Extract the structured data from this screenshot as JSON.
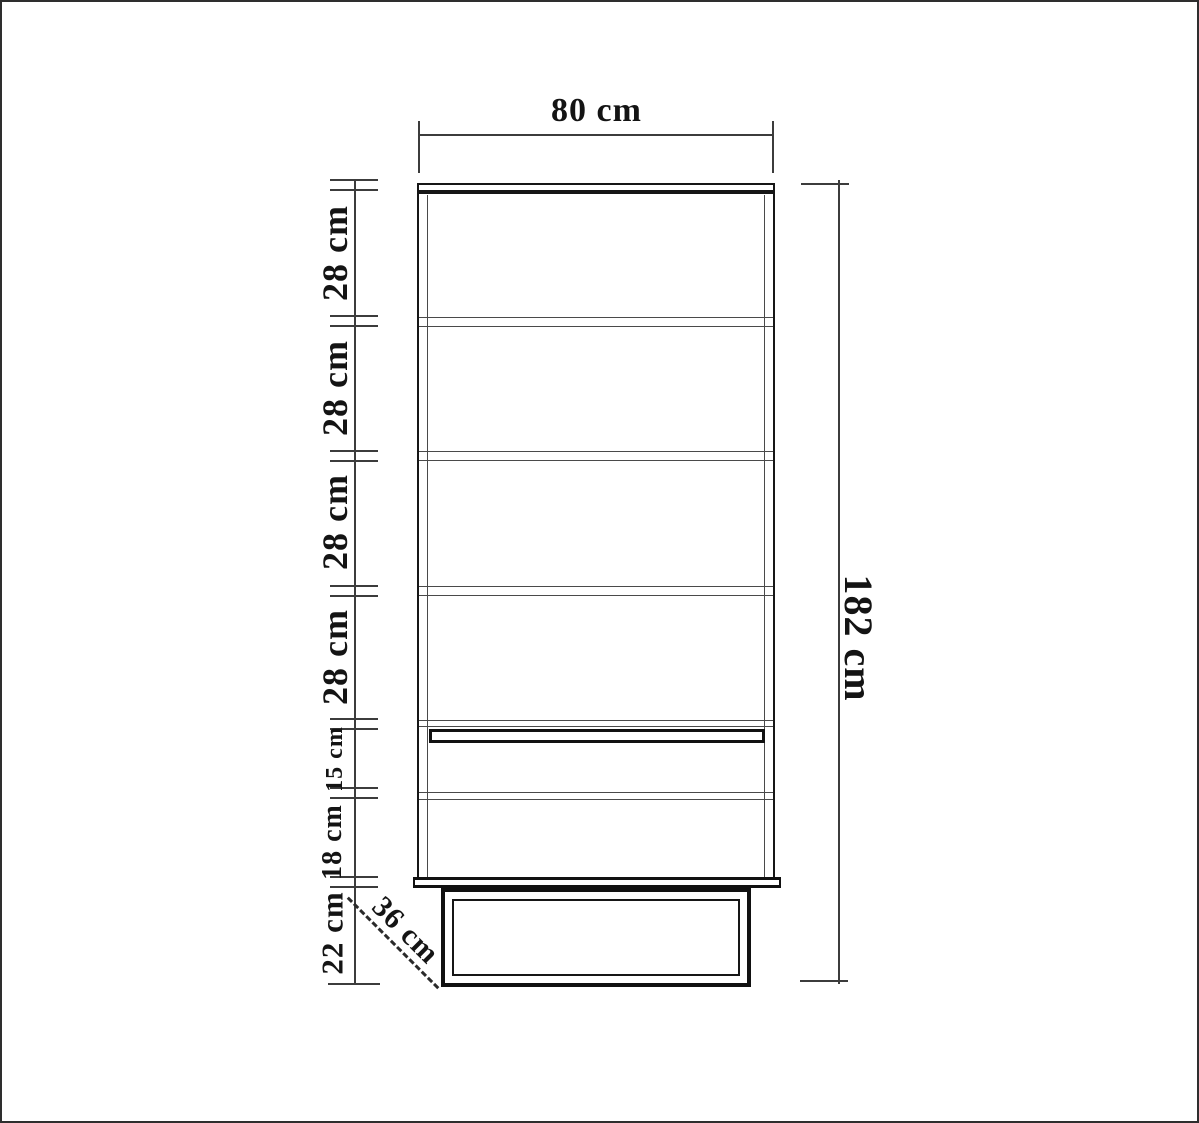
{
  "title": "Cabinet dimension drawing",
  "measurements": {
    "top_width": {
      "value": "80 cm"
    },
    "right_height": {
      "value": "182 cm"
    },
    "depth": {
      "value": "36 cm"
    },
    "left_segments": [
      {
        "value": "28 cm"
      },
      {
        "value": "28 cm"
      },
      {
        "value": "28 cm"
      },
      {
        "value": "28 cm"
      },
      {
        "value": "15 cm"
      },
      {
        "value": "18 cm"
      },
      {
        "value": "22 cm"
      }
    ]
  },
  "colors": {
    "ink": "#161616",
    "dimension_line": "#3c3c3c",
    "background": "#ffffff",
    "canvas_border": "#2e2e2e"
  }
}
